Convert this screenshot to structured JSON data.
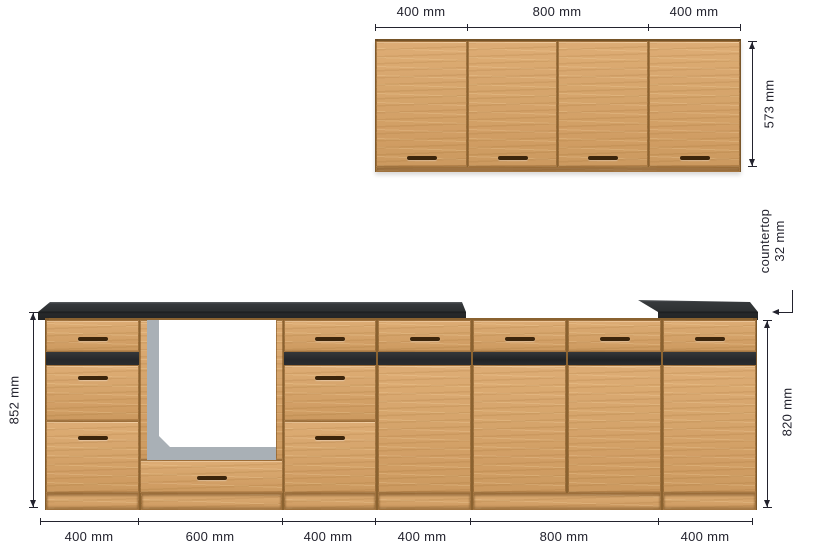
{
  "wall": {
    "width_labels": [
      "400 mm",
      "800 mm",
      "400 mm"
    ],
    "height_label": "573 mm",
    "doors": 4
  },
  "countertop_note": {
    "line1": "countertop",
    "line2": "32 mm"
  },
  "base": {
    "height_with_countertop_label": "852 mm",
    "height_cabinet_label": "820 mm",
    "width_labels": [
      "400 mm",
      "600 mm",
      "400 mm",
      "400 mm",
      "800 mm",
      "400 mm"
    ],
    "cabinets": [
      {
        "width_mm": 400,
        "type": "drawers-3"
      },
      {
        "width_mm": 600,
        "type": "oven-housing"
      },
      {
        "width_mm": 400,
        "type": "drawers-3"
      },
      {
        "width_mm": 400,
        "type": "drawer-door"
      },
      {
        "width_mm": 800,
        "type": "drawer-door-double"
      },
      {
        "width_mm": 400,
        "type": "drawer-door"
      }
    ]
  },
  "colors": {
    "wood": "#d9a365",
    "countertop": "#232527",
    "accent_strip": "#26282b",
    "handle": "#3c250b",
    "oven_frame": "#a9b0b6",
    "oven_opening": "#ffffff",
    "dimension": "#23232e",
    "background": "#ffffff"
  }
}
